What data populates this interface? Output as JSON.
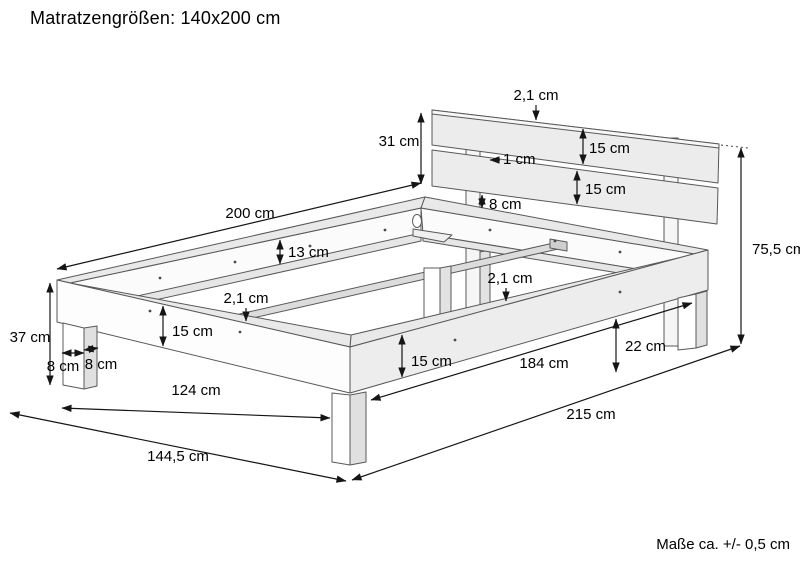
{
  "title": "Matratzengrößen: 140x200 cm",
  "tolerance_note": "Maße ca. +/- 0,5 cm",
  "colors": {
    "line": "#585858",
    "dimension_line": "#151515",
    "face_white": "#fdfdfd",
    "face_gray": "#ededed",
    "top_band": "#e9e9e9"
  },
  "diagram": {
    "type": "technical-drawing",
    "subject": "Double bed frame with slatted headboard, perspective view with measurements",
    "dimensions": [
      {
        "id": "headboard-height",
        "label": "31 cm",
        "value_cm": 31
      },
      {
        "id": "headboard-thickness",
        "label": "2,1 cm",
        "value_cm": 2.1
      },
      {
        "id": "headboard-top-board",
        "label": "15 cm",
        "value_cm": 15
      },
      {
        "id": "headboard-board-gap",
        "label": "1 cm",
        "value_cm": 1
      },
      {
        "id": "headboard-bottom-board",
        "label": "15 cm",
        "value_cm": 15
      },
      {
        "id": "headboard-to-frame-gap",
        "label": "8 cm",
        "value_cm": 8
      },
      {
        "id": "frame-length",
        "label": "200 cm",
        "value_cm": 200
      },
      {
        "id": "frame-inner-depth",
        "label": "13 cm",
        "value_cm": 13
      },
      {
        "id": "slat-rail-thickness",
        "label": "2,1 cm",
        "value_cm": 2.1
      },
      {
        "id": "side-rail-height-front",
        "label": "15 cm",
        "value_cm": 15
      },
      {
        "id": "leg-height",
        "label": "37 cm",
        "value_cm": 37
      },
      {
        "id": "leg-width",
        "label": "8 cm",
        "value_cm": 8
      },
      {
        "id": "leg-depth",
        "label": "8 cm",
        "value_cm": 8
      },
      {
        "id": "inner-leg-span-width",
        "label": "124 cm",
        "value_cm": 124
      },
      {
        "id": "overall-width",
        "label": "144,5 cm",
        "value_cm": 144.5
      },
      {
        "id": "side-rail-height-side",
        "label": "15 cm",
        "value_cm": 15
      },
      {
        "id": "center-bar-thickness",
        "label": "2,1 cm",
        "value_cm": 2.1
      },
      {
        "id": "leg-span-length",
        "label": "184 cm",
        "value_cm": 184
      },
      {
        "id": "floor-clearance",
        "label": "22 cm",
        "value_cm": 22
      },
      {
        "id": "overall-length",
        "label": "215 cm",
        "value_cm": 215
      },
      {
        "id": "overall-height",
        "label": "75,5 cm",
        "value_cm": 75.5
      }
    ]
  }
}
